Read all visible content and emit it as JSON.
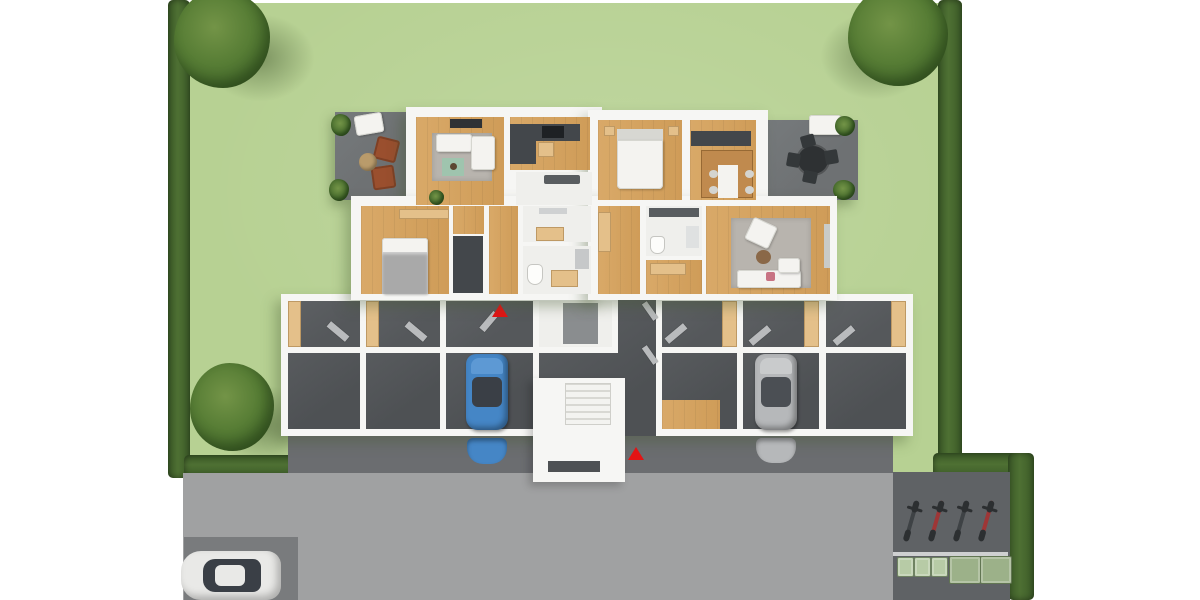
{
  "meta": {
    "title": "Top-down 3D architectural floor plan rendering",
    "view": "site plan with garden, ground-floor apartments over basement garages, street and parking",
    "visible_text": "none"
  },
  "palette": {
    "lawn": "#b7d193",
    "hedge": "#4e7033",
    "hedgeDark": "#3c5b28",
    "tree": "#577d35",
    "treeMid": "#476c2d",
    "treeDark": "#3a5a25",
    "treeHi": "#739447",
    "road": "#a0a1a2",
    "driveway": "#6b6d70",
    "pad": "#797b7d",
    "yard": "#5f6265",
    "wall": "#f6f6f4",
    "roomWhite": "#efefec",
    "wood": "#d9a968",
    "wood2": "#cf9c58",
    "woodLight": "#e4c08a",
    "charcoal": "#43474b",
    "rugGray": "#b8b4ae",
    "rugGreen": "#9fc4ae",
    "patio": "#6e7173",
    "terra": "#9a4f2e",
    "ottoman": "#b99b6b",
    "white": "#f4f3f0",
    "bedGray": "#a9a9a9",
    "elevator": "#8a8d8f",
    "garage": "#4e5154",
    "storage": "#55585b",
    "glass": "#3a3f46",
    "blueCar": "#4586c6",
    "blueCarHood": "#5d99d4",
    "silverCar": "#b6b8ba",
    "silverCarHood": "#c9cbcc",
    "whiteCar": "#e9e9e7",
    "marker": "#e31414",
    "rail": "#cfd0d1",
    "binSmall": "#b7cba6",
    "binLarge": "#9cb189",
    "pillowPink": "#c87383"
  },
  "landscape": {
    "lawn_label": "garden lawn",
    "hedges": [
      "left boundary hedge",
      "right boundary hedge",
      "lower-left hedge",
      "lower-right hedge",
      "far-right hedge"
    ],
    "trees": [
      "top-left tree",
      "top-right tree",
      "middle-left tree"
    ],
    "patio_left": {
      "furniture": [
        "white lounger",
        "terracotta chair",
        "terracotta chair",
        "round ottoman",
        "plant",
        "plant"
      ]
    },
    "patio_right": {
      "furniture": [
        "white bench",
        "black bistro table",
        "4 black chairs",
        "plant",
        "plant"
      ]
    }
  },
  "building": {
    "apartment_level_rooms": [
      "living room",
      "kitchen",
      "bedroom",
      "dining room",
      "bedroom 2",
      "closet",
      "hallway",
      "WC",
      "bathroom",
      "bathroom 2",
      "hall 2",
      "storage room",
      "living room 2"
    ],
    "garage_level": {
      "storage_rooms": 6,
      "garage_bays": 6,
      "elevator": 1,
      "stairwell": 1,
      "entry_markers": 2
    }
  },
  "site": {
    "road_label": "street",
    "driveway_label": "garage forecourt",
    "parking_space_label": "outdoor parking space",
    "bike_parking": {
      "bicycles": [
        {
          "label": "bicycle",
          "color": "#3e4245"
        },
        {
          "label": "bicycle",
          "color": "#9e3636"
        },
        {
          "label": "bicycle",
          "color": "#3e4245"
        },
        {
          "label": "bicycle",
          "color": "#9e3636"
        }
      ]
    },
    "waste_bins": {
      "small_count": 3,
      "large_count": 2
    }
  },
  "vehicles": [
    {
      "type": "car",
      "color": "blue",
      "location": "garage bay"
    },
    {
      "type": "car",
      "color": "silver",
      "location": "garage bay"
    },
    {
      "type": "car",
      "color": "white",
      "location": "outdoor parking"
    }
  ]
}
